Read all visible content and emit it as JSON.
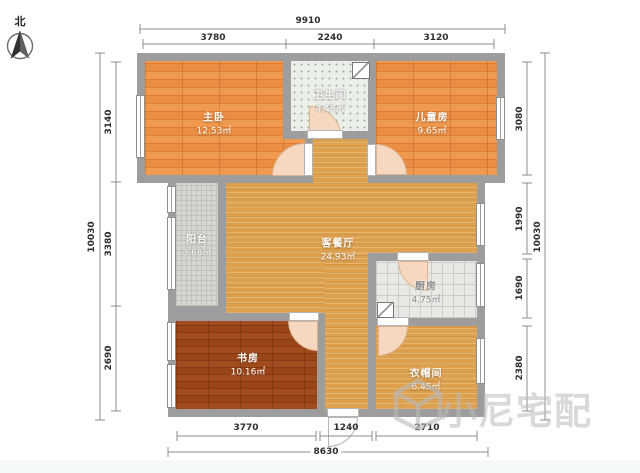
{
  "compass": {
    "label": "北"
  },
  "rooms": [
    {
      "id": "master-bedroom",
      "name": "主卧",
      "area": "12.53㎡"
    },
    {
      "id": "bathroom",
      "name": "卫生间",
      "area": "4.45㎡"
    },
    {
      "id": "kids-room",
      "name": "儿童房",
      "area": "9.65㎡"
    },
    {
      "id": "balcony",
      "name": "阳台",
      "area": "3.68㎡"
    },
    {
      "id": "living-dining",
      "name": "客餐厅",
      "area": "24.93㎡"
    },
    {
      "id": "kitchen",
      "name": "厨房",
      "area": "4.75㎡"
    },
    {
      "id": "study",
      "name": "书房",
      "area": "10.16㎡"
    },
    {
      "id": "cloakroom",
      "name": "衣帽间",
      "area": "6.45㎡"
    }
  ],
  "dimensions": {
    "top": {
      "total": "9910",
      "segments": [
        "3780",
        "2240",
        "3120"
      ]
    },
    "left": {
      "total": "10030",
      "segments": [
        "3140",
        "3380",
        "2690"
      ]
    },
    "right": {
      "total": "10030",
      "segments": [
        "3080",
        "1990",
        "1690",
        "2380"
      ]
    },
    "bottom": {
      "total": "8630",
      "segments": [
        "3770",
        "1240",
        "2710"
      ]
    }
  },
  "watermark": {
    "text": "小尼宅配"
  },
  "palette": {
    "wall": "#9d9d9d",
    "wood_orange": "#e8893e",
    "wood_light": "#dda04e",
    "wood_dark": "#96431a",
    "tile_light": "#e8e8e5",
    "door_arc": "#f6d8c0"
  }
}
